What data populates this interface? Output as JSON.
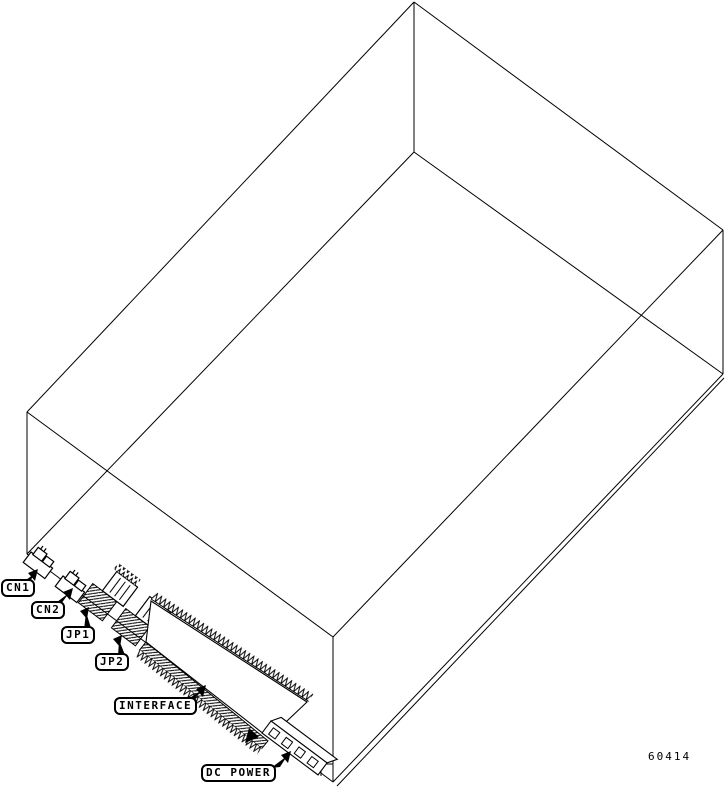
{
  "figure": {
    "part_number": "60414",
    "callouts": [
      {
        "id": "cn1",
        "label": "CN1"
      },
      {
        "id": "cn2",
        "label": "CN2"
      },
      {
        "id": "jp1",
        "label": "JP1"
      },
      {
        "id": "jp2",
        "label": "JP2"
      },
      {
        "id": "interface",
        "label": "INTERFACE"
      },
      {
        "id": "dc_power",
        "label": "DC POWER"
      }
    ],
    "components": [
      "cn1-connector",
      "cn2-connector",
      "jp1-jumper-block",
      "jp2-jumper-block",
      "interface-connector",
      "dc-power-connector",
      "drive-enclosure"
    ]
  },
  "colors": {
    "line": "#000000",
    "background": "#ffffff"
  }
}
